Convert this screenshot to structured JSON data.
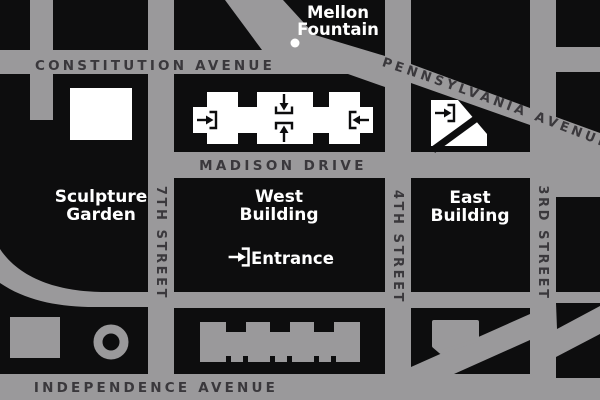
{
  "map": {
    "title": "National Gallery area street map",
    "colors": {
      "road_gray": "#9a999b",
      "block_black": "#0d0d0e",
      "building_white": "#ffffff",
      "building_gray": "#9a999b",
      "street_text": "#3a383c",
      "place_text": "#ffffff"
    },
    "streets": {
      "constitution": "CONSTITUTION AVENUE",
      "pennsylvania": "PENNSYLVANIA AVENUE",
      "madison": "MADISON DRIVE",
      "independence": "INDEPENDENCE AVENUE",
      "seventh": "7TH STREET",
      "fourth": "4TH STREET",
      "third": "3RD STREET"
    },
    "places": {
      "mellon_line1": "Mellon",
      "mellon_line2": "Fountain",
      "sculpture_line1": "Sculpture",
      "sculpture_line2": "Garden",
      "west_line1": "West",
      "west_line2": "Building",
      "east_line1": "East",
      "east_line2": "Building",
      "entrance": "Entrance"
    },
    "icons": [
      "entrance-arrow-right-icon",
      "entrance-arrow-down-icon",
      "entrance-arrow-up-icon",
      "entrance-arrow-left-icon",
      "fountain-dot-icon"
    ]
  }
}
